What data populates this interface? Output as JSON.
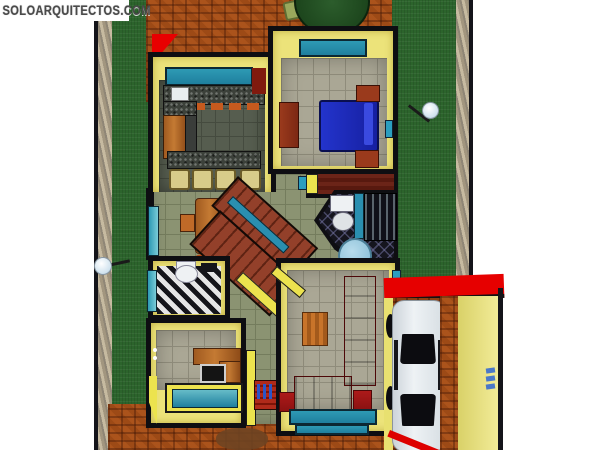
{
  "watermark": {
    "text": "SOLOARQUITECTOS.COM"
  },
  "scene": {
    "description": "Top-down 3D architectural render of a single-storey house: lawn with boundary walls, brick patio with round garden table, kitchen with breakfast bar, dining area, blue double bed bedroom, two bathrooms, central staircase, home office, living room with red sofas, and a carport with a white car under a red roof",
    "rooms": [
      "garden-lawn",
      "brick-patio",
      "kitchen",
      "dining-area",
      "bedroom",
      "wardrobe-closet",
      "main-bathroom",
      "guest-bathroom",
      "staircase",
      "hallway",
      "home-office",
      "entry-steps",
      "living-room",
      "carport-driveway"
    ],
    "furniture": [
      "round-patio-table",
      "patio-chairs",
      "kitchen-counter",
      "breakfast-bar-stools",
      "refrigerator-cabinet",
      "dining-table",
      "dining-chairs",
      "double-bed",
      "nightstands",
      "dresser",
      "toilet",
      "sink",
      "shower",
      "round-side-table",
      "red-ottoman",
      "office-desk",
      "computer-monitor",
      "long-sofa",
      "loveseat",
      "coffee-table",
      "side-tables",
      "white-car",
      "garden-lamps"
    ]
  },
  "palette": {
    "background": "#ffffff",
    "grass": "#2c642c",
    "brick": "#9d4a16",
    "wall_yellow": "#ece37a",
    "outline_black": "#0e0e12",
    "window_teal": "#2b9ec0",
    "furniture_red": "#a01515",
    "bed_blue": "#1e2ab4",
    "wood": "#b06a2a",
    "roof_red": "#e60000",
    "car_white": "#e6eaee",
    "tile_gray": "#aaa795"
  }
}
